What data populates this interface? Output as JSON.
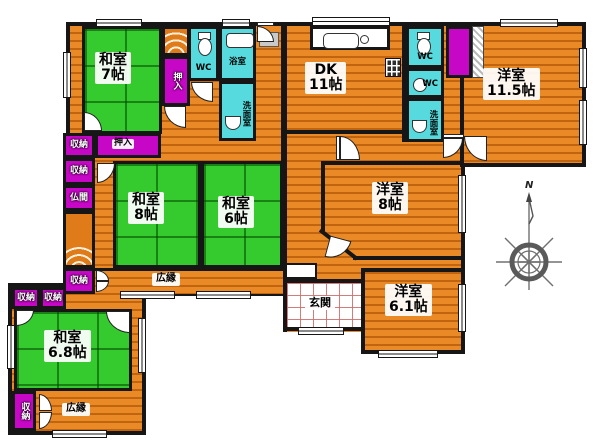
{
  "rooms": {
    "washitsu7": {
      "name": "和室",
      "size": "7帖"
    },
    "washitsu8": {
      "name": "和室",
      "size": "8帖"
    },
    "washitsu6": {
      "name": "和室",
      "size": "6帖"
    },
    "washitsu68": {
      "name": "和室",
      "size": "6.8帖"
    },
    "dk": {
      "name": "DK",
      "size": "11帖"
    },
    "yoshitsu115": {
      "name": "洋室",
      "size": "11.5帖"
    },
    "yoshitsu8": {
      "name": "洋室",
      "size": "8帖"
    },
    "yoshitsu61": {
      "name": "洋室",
      "size": "6.1帖"
    }
  },
  "areas": {
    "hiroen": "広縁",
    "genkan": "玄関"
  },
  "storage": {
    "oshiire": "押入",
    "shuno": "収納",
    "butsuma": "仏間"
  },
  "sanitary": {
    "wc": "WC",
    "bath": "浴室",
    "senmen": "洗面室"
  },
  "compass": {
    "north": "N"
  },
  "colors": {
    "tatami_green": "#35cb2f",
    "wood_orange": "#ea8a26",
    "storage_purple": "#c607c6",
    "wet_cyan": "#56dadd",
    "wall_black": "#161616"
  }
}
